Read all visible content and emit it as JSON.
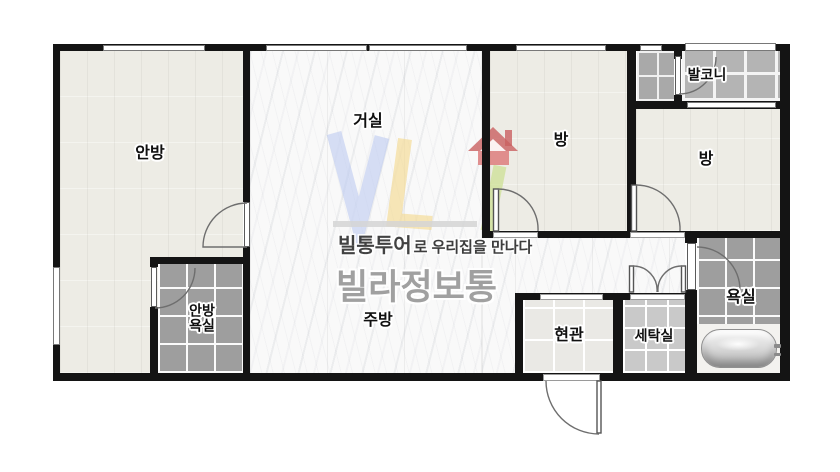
{
  "plan": {
    "type": "apartment-floor-plan",
    "labels": {
      "anbang": "안방",
      "geosil": "거실",
      "jubang": "주방",
      "bang1": "방",
      "bang2": "방",
      "balkoni": "발코니",
      "anbang_yoksil_line1": "안방",
      "anbang_yoksil_line2": "욕실",
      "hyeongwan": "현관",
      "setaksil": "세탁실",
      "yoksil": "욕실"
    }
  },
  "watermark": {
    "logo_letters": "VL",
    "tagline_bold": "빌통투어",
    "tagline_rest": "로 우리집을 만나다",
    "brand": "빌라정보통"
  },
  "colors": {
    "wall": "#141414",
    "wood_floor": "#edece5",
    "marble_floor": "#f9f9f9",
    "tile_dark": "#9e9e9e",
    "tile_laundry": "#c9c9c9",
    "tile_entry": "#eae9e5",
    "tile_balcony": "#b4b4b4",
    "logo_blue": "#bcc9f0",
    "logo_yellow": "#f4d88d",
    "logo_red": "#cf6060",
    "logo_green": "#cbdf90",
    "brand_gray": "#9c9c9c"
  }
}
